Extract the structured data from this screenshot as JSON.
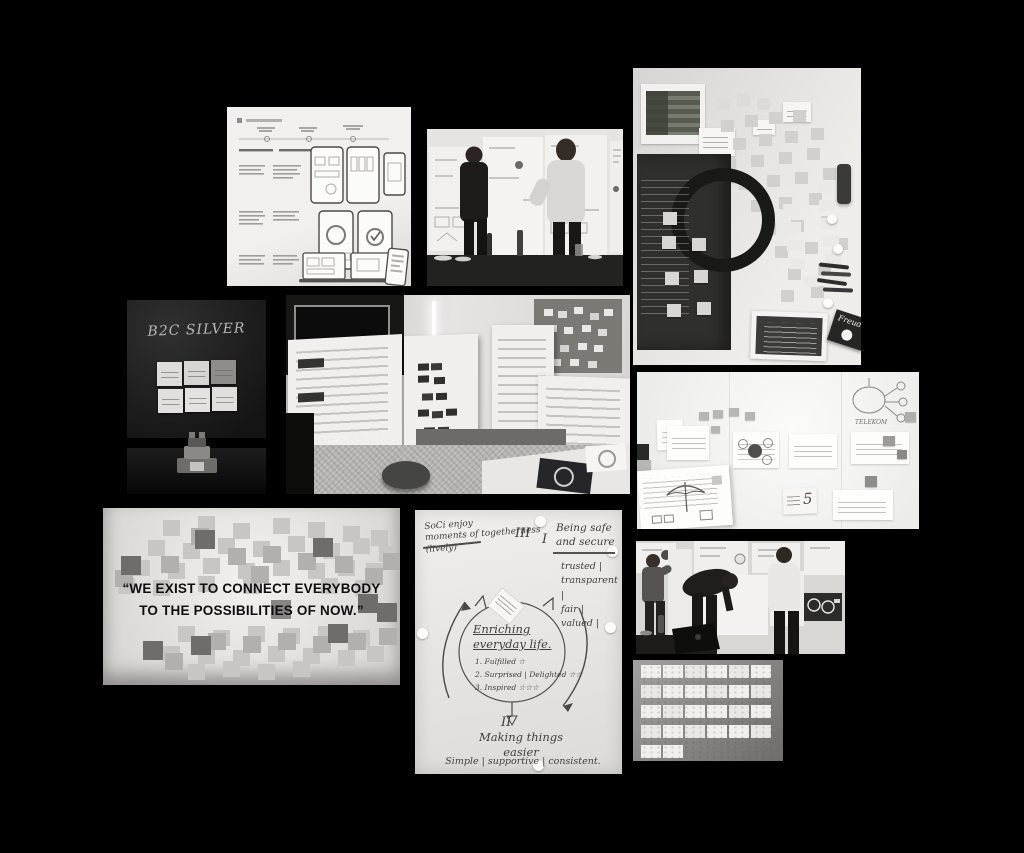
{
  "page": {
    "background_color": "#000000"
  },
  "colors": {
    "canvas_background": "#000000",
    "wall_light": "#e8e6e3",
    "sticky_light": "#c8c6c3",
    "sticky_mid": "#b2b0ad",
    "sticky_dark": "#6f6d6a",
    "chalkboard_dark": "#161616",
    "handwriting_ink": "#3e3e3c"
  },
  "b2c": {
    "title": "B2C SILVER"
  },
  "quote": {
    "line1": "“WE EXIST TO CONNECT EVERYBODY",
    "line2": "TO THE POSSIBILITIES OF NOW.”"
  },
  "whiteboard": {
    "five_label": "5",
    "telekom_label": "TELEKOM"
  },
  "sticky_wall": {
    "freude_label": "Freude"
  },
  "flipchart": {
    "intro_line1": "SoCi enjoy",
    "intro_line2": "moments of togetherness",
    "intro_line3": "(lively)",
    "numeral_three": "III",
    "numeral_one": "I",
    "safe_line1": "Being safe",
    "safe_line2": "and secure",
    "safe_values": "trusted |\ntransparent |\nfair |\nvalued |",
    "circle_line1": "Enriching",
    "circle_line2": "everyday life.",
    "circle_item1": "1. Fulfilled ☆",
    "circle_item2": "2. Surprised | Delighted ☆☆",
    "circle_item3": "3. Inspired ☆☆☆",
    "numeral_two": "II",
    "easier_line1": "Making things",
    "easier_line2": "easier",
    "bottom_values": "Simple | supportive | consistent."
  }
}
